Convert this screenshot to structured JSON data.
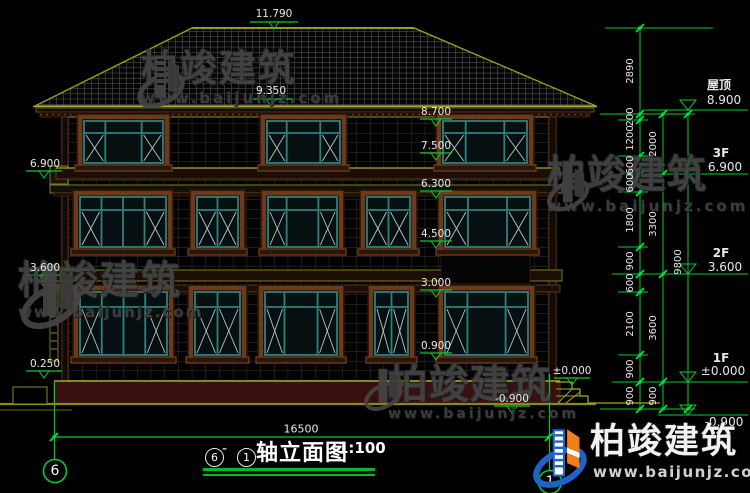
{
  "drawing": {
    "title": {
      "axis_from": "6",
      "dash": "-",
      "axis_to": "1",
      "name": "轴立面图",
      "scale": "1:100"
    },
    "overall_width_dim": "16500",
    "top_level_marks": [
      "11.790",
      "9.350"
    ],
    "left_level_marks": [
      "6.900",
      "3.600",
      "0.250"
    ],
    "facade_level_marks": [
      "8.700",
      "7.500",
      "6.300",
      "4.500",
      "3.000",
      "0.900",
      "±0.000",
      "-0.900"
    ],
    "right_floor_marks": [
      {
        "label": "屋顶",
        "value": "8.900"
      },
      {
        "label": "3F",
        "value": "6.900"
      },
      {
        "label": "2F",
        "value": "3.600"
      },
      {
        "label": "1F",
        "value": "±0.000"
      },
      {
        "label": "",
        "value": "-0.900"
      }
    ],
    "dim_col1": [
      "2890",
      "200",
      "1200",
      "600",
      "600",
      "1800",
      "900",
      "600",
      "2100",
      "900",
      "900"
    ],
    "dim_col2": [
      "2000",
      "3300",
      "3600",
      "900"
    ],
    "dim_col3": [
      "9800"
    ],
    "axis_bubbles": {
      "left": "6",
      "right": "1"
    }
  },
  "watermark": {
    "brand": "柏竣建筑",
    "url": "www.baijunjz.com"
  },
  "logo": {
    "brand": "柏竣建筑",
    "url": "www.baijunjz.com"
  },
  "colors": {
    "dim_green": "#00cc33",
    "outline_olive": "#9a9a20",
    "olive_dim": "#6a6a10",
    "frame_teal": "#2f8080",
    "trim_brown": "#6b3a1d",
    "trim_dark": "#2a1405",
    "foundation_maroon": "#381010",
    "x_line": "#b9c6c6",
    "logo_blue": "#1e64c8",
    "logo_orange": "#f08019",
    "text_white": "#e8e8e8",
    "watermark_gray": "#454545"
  }
}
